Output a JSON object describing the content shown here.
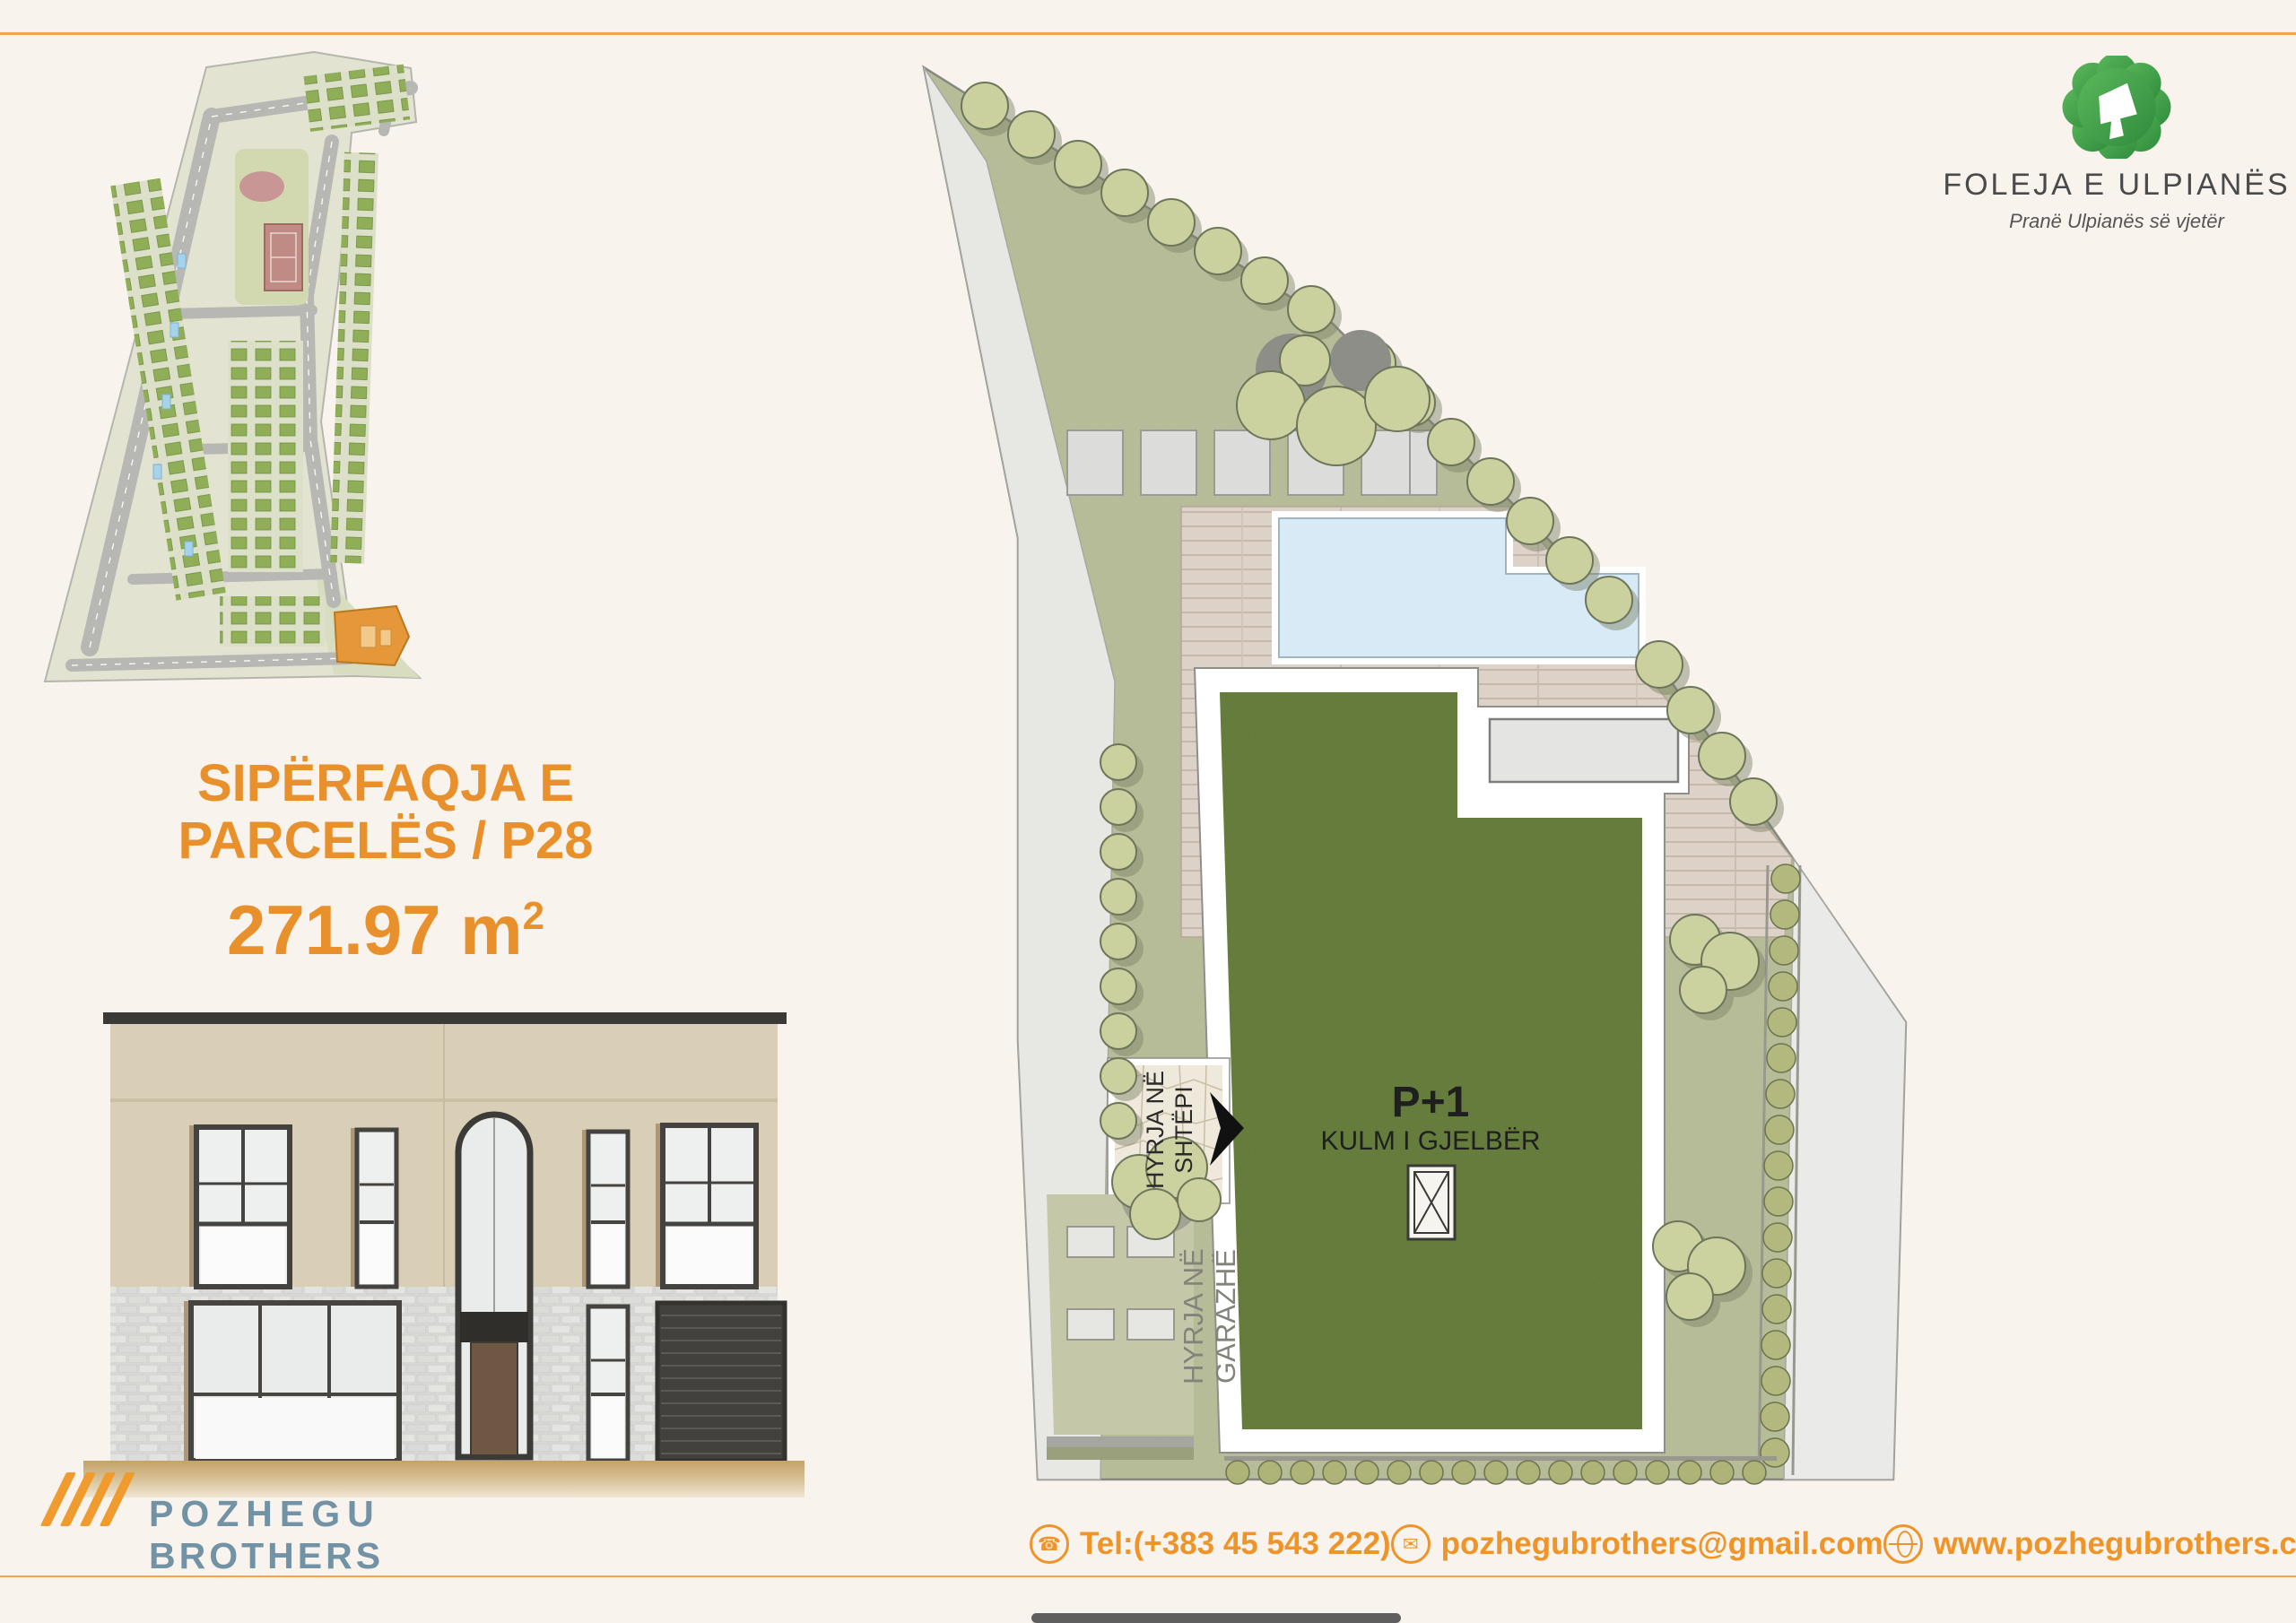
{
  "page": {
    "background": "#f9f3ed",
    "accent_orange": "#e8912c",
    "rule_color": "#f3a44c",
    "slate_blue": "#7292a6",
    "logo_green": "#3f9f45",
    "parcel_highlight": "#e5973a"
  },
  "brand": {
    "name": "FOLEJA E ULPIANËS",
    "tagline": "Pranë Ulpianës së vjetër",
    "logo_icon": "clover-4-icon"
  },
  "parcel_info": {
    "title_line1": "SIPËRFAQJA E",
    "title_line2": "PARCELËS / P28",
    "area_value": "271.97 m",
    "area_superscript": "2"
  },
  "parcel_plan": {
    "roof_label_title": "P+1",
    "roof_label_subtitle": "KULM I GJELBËR",
    "entrance_house_line1": "HYRJA NË",
    "entrance_house_line2": "SHTËPI",
    "entrance_garage_line1": "HYRJA NË",
    "entrance_garage_line2": "GARAZHË"
  },
  "company": {
    "name_line1": "POZHEGU",
    "name_line2": "BROTHERS",
    "slashes_icon": "four-slashes-icon"
  },
  "contact": {
    "tel": "Tel:(+383 45 543 222)",
    "email": "pozhegubrothers@gmail.com",
    "website": "www.pozhegubrothers.com"
  }
}
